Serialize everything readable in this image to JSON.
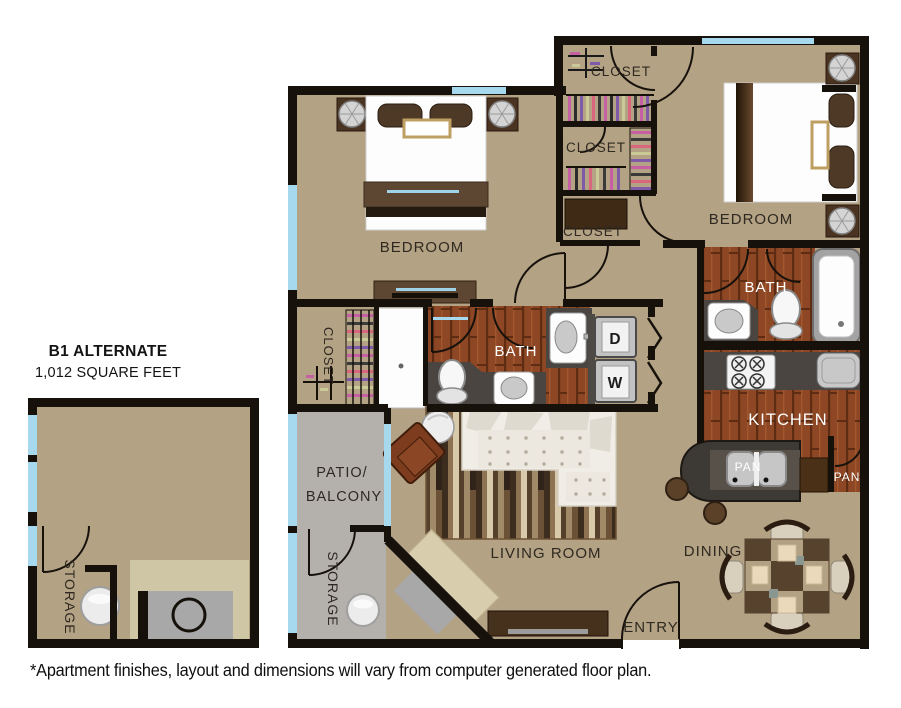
{
  "plan_header": {
    "title": "B1 ALTERNATE",
    "subtitle": "1,012 SQUARE FEET"
  },
  "footnote": "*Apartment finishes, layout and dimensions will vary from computer generated floor plan.",
  "labels": {
    "bedroom_left": "BEDROOM",
    "bedroom_right": "BEDROOM",
    "closet_top": "CLOSET",
    "closet_mid": "CLOSET",
    "closet_hall": "CLOSET",
    "closet_inner": "CLOSET",
    "bath_main": "BATH",
    "bath_ensuite": "BATH",
    "kitchen": "KITCHEN",
    "pan_closet": "PAN",
    "pan_sink": "PAN",
    "dining": "DINING",
    "living_room": "LIVING ROOM",
    "patio_line1": "PATIO/",
    "patio_line2": "BALCONY",
    "storage_patio": "STORAGE",
    "storage_unit": "STORAGE",
    "entry": "ENTRY",
    "dryer": "D",
    "washer": "W"
  },
  "colors": {
    "floor_tan": "#b3a284",
    "wall": "#16110b",
    "window_blue": "#a6d9ee",
    "wood_floor": "#8d4724",
    "patio_gray": "#b4b1ad",
    "counter_gray": "#4a4541"
  }
}
